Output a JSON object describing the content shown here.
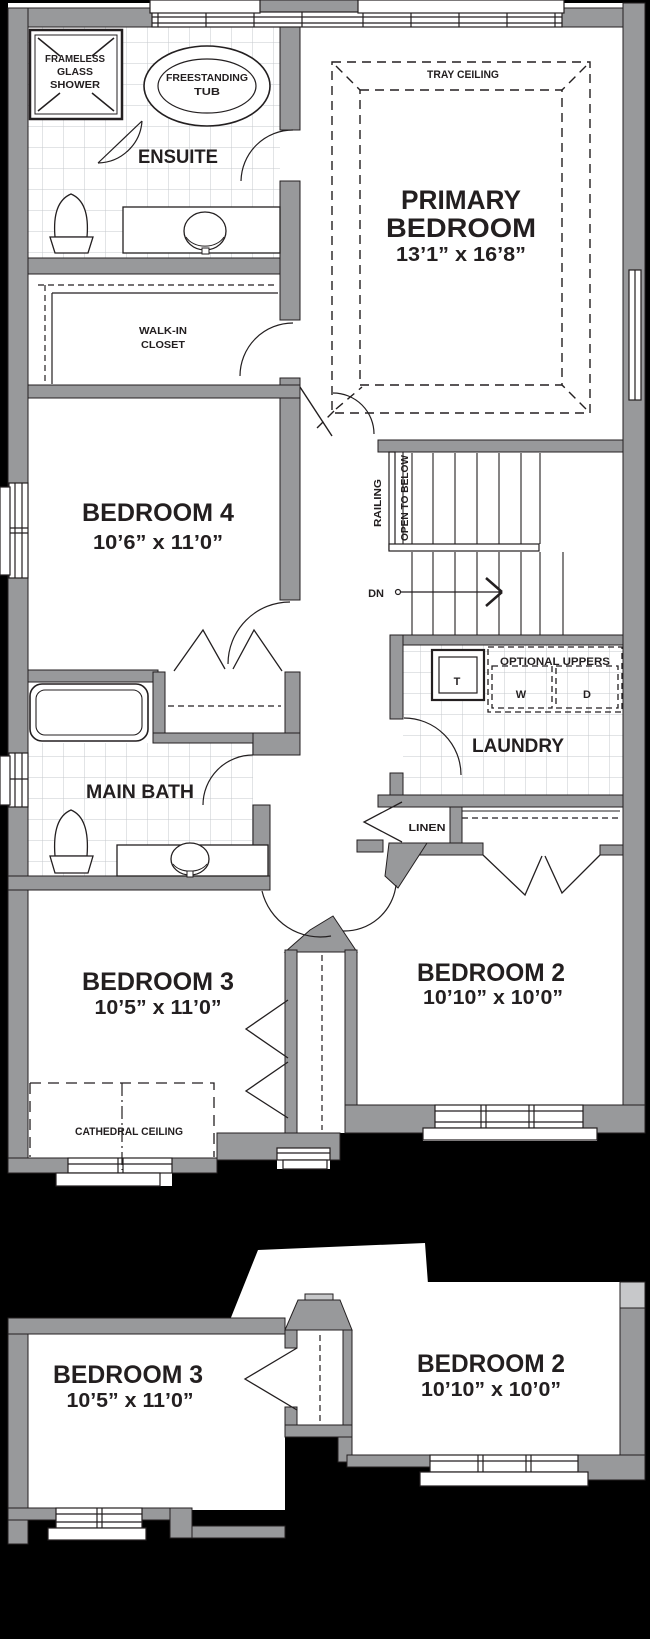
{
  "colors": {
    "wall": "#98999b",
    "wall_light": "#c7c8ca",
    "outline": "#231f20",
    "tile_line": "#c5c9cc",
    "background": "#000000",
    "floor": "#ffffff"
  },
  "plan": {
    "ensuite": {
      "label": "ENSUITE",
      "shower": {
        "line1": "FRAMELESS",
        "line2": "GLASS",
        "line3": "SHOWER"
      },
      "tub": {
        "line1": "FREESTANDING",
        "line2": "TUB"
      }
    },
    "primary_bedroom": {
      "ceiling": "TRAY CEILING",
      "name_line1": "PRIMARY",
      "name_line2": "BEDROOM",
      "dims": "13’1” x 16’8”"
    },
    "walk_in_closet": {
      "line1": "WALK-IN",
      "line2": "CLOSET"
    },
    "bedroom4": {
      "name": "BEDROOM 4",
      "dims": "10’6” x 11’0”"
    },
    "stairs": {
      "railing": "RAILING",
      "open_to_below": "OPEN TO BELOW",
      "down": "DN"
    },
    "laundry": {
      "name": "LAUNDRY",
      "tub": "T",
      "uppers": "OPTIONAL UPPERS",
      "washer": "W",
      "dryer": "D"
    },
    "linen": {
      "name": "LINEN"
    },
    "main_bath": {
      "name": "MAIN BATH"
    },
    "bedroom3": {
      "name": "BEDROOM 3",
      "dims": "10’5” x 11’0”",
      "ceiling": "CATHEDRAL CEILING"
    },
    "bedroom2": {
      "name": "BEDROOM 2",
      "dims": "10’10” x 10’0”"
    }
  },
  "alternate": {
    "bedroom3": {
      "name": "BEDROOM 3",
      "dims": "10’5” x 11’0”"
    },
    "bedroom2": {
      "name": "BEDROOM 2",
      "dims": "10’10” x 10’0”"
    }
  }
}
